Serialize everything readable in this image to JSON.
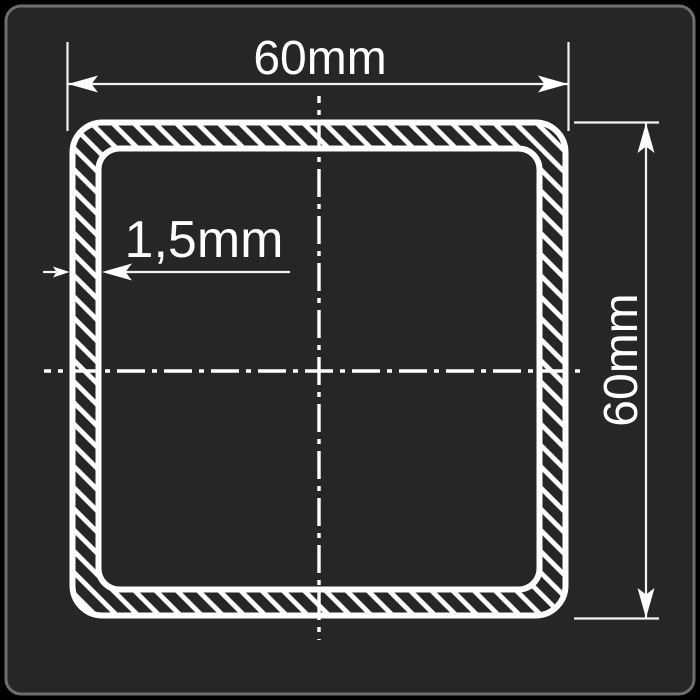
{
  "drawing": {
    "labels": {
      "width": "60mm",
      "height": "60mm",
      "wall_thickness": "1,5mm"
    },
    "colors": {
      "canvas_background": "#000000",
      "panel_background": "#262626",
      "panel_border": "#6e6e6e",
      "linework": "#ffffff"
    }
  }
}
